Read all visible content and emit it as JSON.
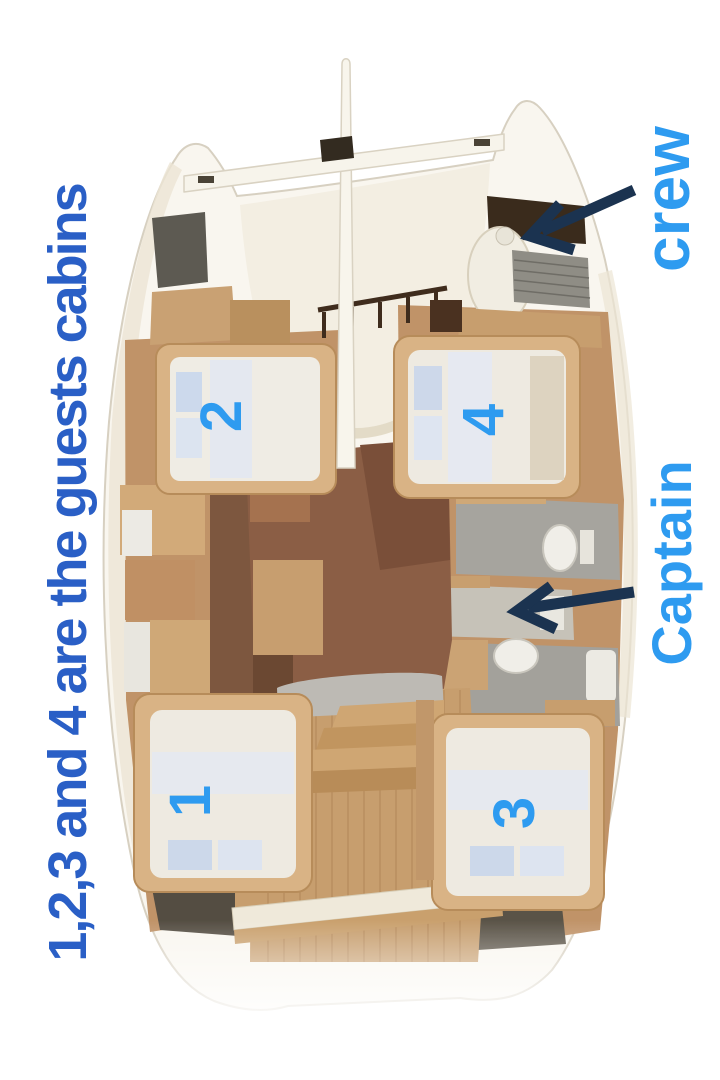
{
  "figure": {
    "description_caption": "1,2,3 and 4 are the guests cabins",
    "labels": {
      "crew": "crew",
      "captain": "Captain"
    },
    "cabins": [
      {
        "id": "cabin-1",
        "label": "1"
      },
      {
        "id": "cabin-2",
        "label": "2"
      },
      {
        "id": "cabin-3",
        "label": "3"
      },
      {
        "id": "cabin-4",
        "label": "4"
      }
    ],
    "colors": {
      "caption_blue": "#2a5fc6",
      "label_blue": "#2e9bf0",
      "arrow_navy": "#1b3350"
    }
  }
}
